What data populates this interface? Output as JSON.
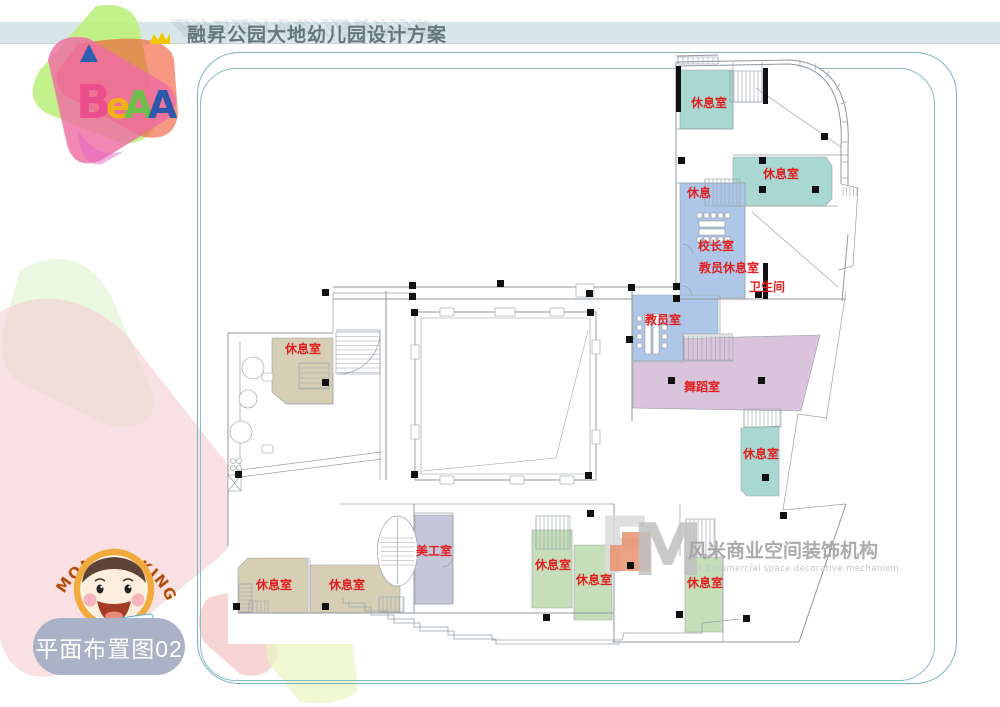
{
  "header": {
    "title": "融昇公园大地幼儿园设计方案"
  },
  "sheet_label": "平面布置图02",
  "logo": {
    "letters": [
      "B",
      "e",
      "A",
      "A"
    ]
  },
  "monkey": {
    "arc": "MONKEY KING",
    "ribbon": "JIANGLIUER"
  },
  "watermark": {
    "f": "F",
    "m": "M",
    "cn": "风米商业空间装饰机构",
    "en": "F.M Commercial space decorative mechanism"
  },
  "plan": {
    "palette": {
      "teal": "#a9d8d2",
      "blue": "#aec7e8",
      "purple": "#d9c4dc",
      "beige": "#d6cfb6",
      "green": "#c6dfba",
      "lavender": "#c6c6d9"
    },
    "label_color": "#e02020",
    "rooms": [
      {
        "pts": "680,70 733,70 733,129 680,129",
        "color": "teal",
        "label": "休息室",
        "lx": 709,
        "ly": 107
      },
      {
        "pts": "733,157 826,157 832,166 832,199 825,206 733,206",
        "color": "teal",
        "label": "休息室",
        "lx": 781,
        "ly": 178
      },
      {
        "pts": "680,183 745,183 745,298 680,298",
        "color": "blue",
        "label": "休息",
        "lx": 699,
        "ly": 197
      },
      {
        "pts": "633,295 718,295 718,334 683,334 683,361 633,361",
        "color": "blue",
        "label": "教员室",
        "lx": 663,
        "ly": 324
      },
      {
        "pts": "633,362 683,362 683,338 700,338 820,335 801,411 633,408",
        "color": "purple",
        "label": "舞蹈室",
        "lx": 702,
        "ly": 391
      },
      {
        "pts": "741,428 779,426 779,496 747,496 741,490",
        "color": "teal",
        "label": "休息室",
        "lx": 761,
        "ly": 458
      },
      {
        "pts": "272,338 333,338 333,404 286,404 272,392",
        "color": "beige",
        "label": "休息室",
        "lx": 303,
        "ly": 353
      },
      {
        "pts": "415,515 453,515 453,604 415,604",
        "color": "lavender",
        "label": "美工室",
        "lx": 434,
        "ly": 555
      },
      {
        "pts": "238,568 248,558 308,558 308,613 238,613",
        "color": "beige",
        "label": "休息室",
        "lx": 274,
        "ly": 589
      },
      {
        "pts": "310,565 400,565 400,613 310,613",
        "color": "beige",
        "label": "休息室",
        "lx": 347,
        "ly": 589
      },
      {
        "pts": "532,530 572,530 572,608 532,608",
        "color": "green",
        "label": "休息室",
        "lx": 553,
        "ly": 569
      },
      {
        "pts": "574,545 612,545 612,620 574,620",
        "color": "green",
        "label": "休息室",
        "lx": 594,
        "ly": 584
      },
      {
        "pts": "685,557 723,557 723,632 685,632",
        "color": "green",
        "label": "休息室",
        "lx": 705,
        "ly": 587
      }
    ],
    "extra_labels": [
      {
        "text": "校长室",
        "x": 716,
        "y": 250
      },
      {
        "text": "教员休息室",
        "x": 729,
        "y": 272
      },
      {
        "text": "卫生间",
        "x": 767,
        "y": 291
      }
    ],
    "columns": [
      [
        678,
        157
      ],
      [
        759,
        157
      ],
      [
        759,
        186
      ],
      [
        812,
        186
      ],
      [
        821,
        133
      ],
      [
        673,
        283
      ],
      [
        673,
        295
      ],
      [
        755,
        291
      ],
      [
        409,
        282
      ],
      [
        409,
        293
      ],
      [
        497,
        280
      ],
      [
        586,
        290
      ],
      [
        628,
        284
      ],
      [
        411,
        309
      ],
      [
        587,
        309
      ],
      [
        411,
        471
      ],
      [
        585,
        472
      ],
      [
        322,
        289
      ],
      [
        322,
        379
      ],
      [
        235,
        471
      ],
      [
        233,
        603
      ],
      [
        322,
        603
      ],
      [
        626,
        336
      ],
      [
        668,
        377
      ],
      [
        758,
        377
      ],
      [
        762,
        474
      ],
      [
        587,
        510
      ],
      [
        780,
        512
      ],
      [
        543,
        614
      ],
      [
        676,
        611
      ],
      [
        743,
        615
      ],
      [
        627,
        562
      ]
    ],
    "stairs": [
      {
        "x": 730,
        "y": 71,
        "w": 32,
        "h": 31,
        "dir": "v",
        "step": 4,
        "box": true
      },
      {
        "x": 705,
        "y": 179,
        "w": 35,
        "h": 27,
        "dir": "v",
        "step": 4,
        "box": true
      },
      {
        "x": 684,
        "y": 336,
        "w": 49,
        "h": 24,
        "dir": "v",
        "step": 4.5,
        "box": true
      },
      {
        "x": 336,
        "y": 332,
        "w": 44,
        "h": 42,
        "dir": "h",
        "step": 4.5,
        "box": true
      },
      {
        "x": 299,
        "y": 363,
        "w": 30,
        "h": 26,
        "dir": "h",
        "step": 5,
        "box": true
      },
      {
        "x": 744,
        "y": 409,
        "w": 37,
        "h": 18,
        "dir": "v",
        "step": 4,
        "box": true
      },
      {
        "x": 381,
        "y": 538,
        "w": 33,
        "h": 27,
        "dir": "h",
        "step": 4.5,
        "box": false
      },
      {
        "x": 536,
        "y": 516,
        "w": 34,
        "h": 33,
        "dir": "v",
        "step": 4,
        "box": true
      },
      {
        "x": 686,
        "y": 519,
        "w": 29,
        "h": 36,
        "dir": "v",
        "step": 4,
        "box": true
      },
      {
        "x": 239,
        "y": 584,
        "w": 13,
        "h": 28,
        "dir": "h",
        "step": 4,
        "box": true
      },
      {
        "x": 249,
        "y": 601,
        "w": 19,
        "h": 12,
        "dir": "v",
        "step": 4,
        "box": true
      },
      {
        "x": 379,
        "y": 597,
        "w": 25,
        "h": 15,
        "dir": "v",
        "step": 4,
        "box": true
      },
      {
        "x": 678,
        "y": 57,
        "w": 40,
        "h": 7,
        "dir": "v",
        "step": 5,
        "box": true
      },
      {
        "x": 843,
        "y": 187,
        "w": 14,
        "h": 9,
        "dir": "v",
        "step": 3.5,
        "box": false
      }
    ]
  }
}
